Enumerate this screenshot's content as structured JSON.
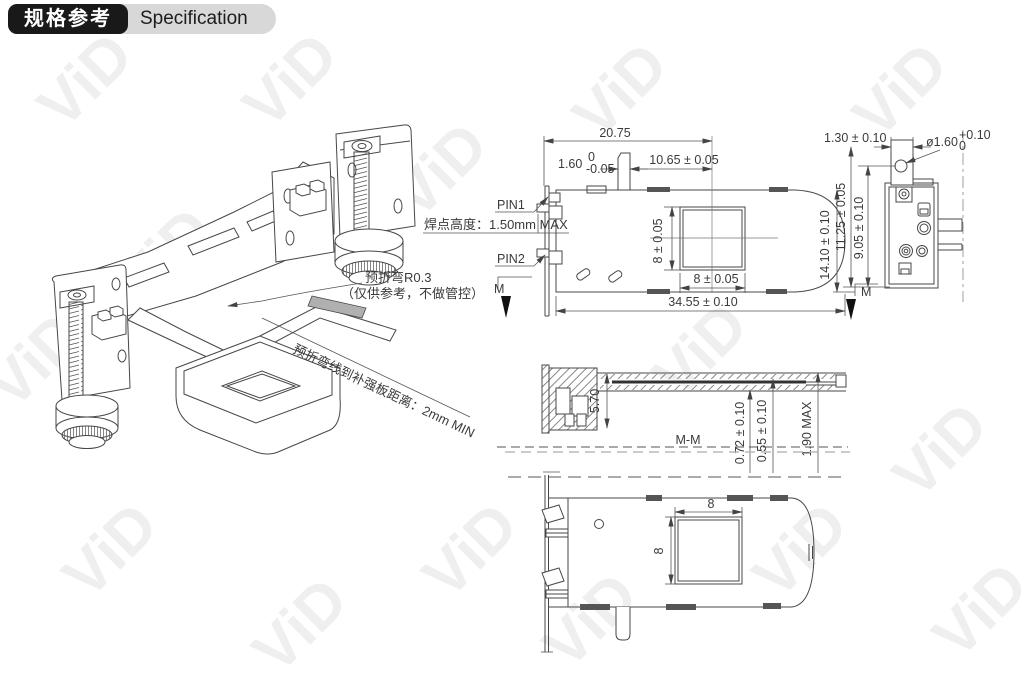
{
  "header": {
    "title_cn": "规格参考",
    "title_en": "Specification"
  },
  "watermark": {
    "text": "ViD"
  },
  "iso": {
    "note_prebend_r": "预折弯R0.3",
    "note_prebend_ref": "（仅供参考，不做管控）",
    "note_prebend_dist": "预折弯线到补强板距离：2mm MIN"
  },
  "front": {
    "solder_note": "焊点高度：1.50mm MAX",
    "pin1": "PIN1",
    "pin2": "PIN2",
    "dim_top_total": "20.75",
    "dim_tab_w": "1.60",
    "dim_tab_tol_up": "0",
    "dim_tab_tol_dn": "-0.05",
    "dim_offset": "10.65 ± 0.05",
    "dim_total": "34.55 ± 0.10",
    "dim_height": "14.10 ± 0.10",
    "dim_window_w": "8 ± 0.05",
    "dim_window_h": "8 ± 0.05",
    "mark_m": "M"
  },
  "side": {
    "dim_tab": "1.30 ± 0.10",
    "dim_hole": "ø1.60",
    "hole_tol_up": "+0.10",
    "hole_tol_dn": "0",
    "dim_h1": "11.25 ± 0.05",
    "dim_h2": "9.05 ± 0.10"
  },
  "section": {
    "label": "M-M",
    "dim_a": "0.72 ± 0.10",
    "dim_b": "0.55 ± 0.10",
    "dim_c": "1.90 MAX",
    "dim_d": "5.70"
  },
  "bottom": {
    "dim_w": "8",
    "dim_h": "8"
  }
}
